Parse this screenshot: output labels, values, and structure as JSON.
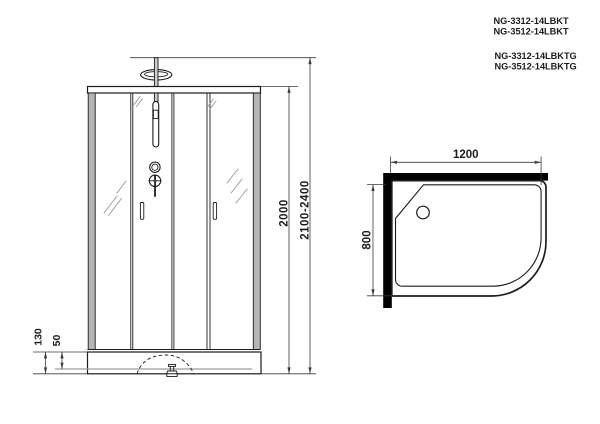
{
  "colors": {
    "ink": "#1c1c1c",
    "dim": "#3a3a3a",
    "wall": "#000000",
    "post": "#b5b5b5",
    "pole": "#cccccc",
    "refl": "#9d9d9d",
    "paper": "#ffffff"
  },
  "models": {
    "variants_kt": [
      "NG-3312-14LBKT",
      "NG-3512-14LBKT"
    ],
    "variants_ktg": [
      "NG-3312-14LBKTG",
      "NG-3512-14LBKTG"
    ]
  },
  "front_view": {
    "dims": {
      "cabin_height": "2000",
      "total_height_range": "2100-2400",
      "tray_height": "130",
      "tray_depth": "50"
    }
  },
  "top_view": {
    "dims": {
      "width": "1200",
      "depth": "800"
    }
  }
}
